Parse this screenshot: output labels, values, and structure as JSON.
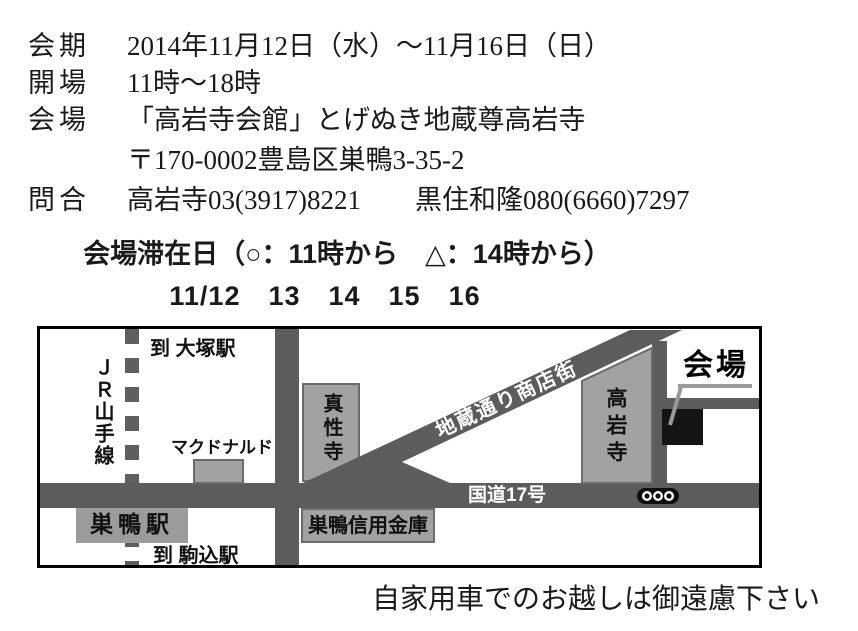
{
  "info": {
    "rows": [
      {
        "label": "会期",
        "value": "2014年11月12日（水）～11月16日（日）"
      },
      {
        "label": "開場",
        "value": "11時～18時"
      },
      {
        "label": "会場",
        "value": "「高岩寺会館」とげぬき地蔵尊高岩寺"
      },
      {
        "label": "",
        "value": "〒170-0002豊島区巣鴨3-35-2"
      },
      {
        "label": "問合",
        "value": "高岩寺03(3917)8221　　黒住和隆080(6660)7297"
      }
    ]
  },
  "schedule": {
    "title_line": "会場滞在日（○：11時から　△：14時から）",
    "dates_line": "11/12　13　14　15　16"
  },
  "map": {
    "labels": {
      "to_otsuka": "到 大塚駅",
      "jr_yamanote": "ＪＲ山手線",
      "mcdonalds": "マクドナルド",
      "shinshoji": "真性寺",
      "sugamo_station": "巣鴨駅",
      "sugamo_shinkin": "巣鴨信用金庫",
      "to_komagome": "到 駒込駅",
      "jizo_street": "地蔵通り商店街",
      "koganji": "高岩寺",
      "route17": "国道17号",
      "venue": "会場"
    },
    "colors": {
      "road": "#5c5c5c",
      "railway": "#5f5f5f",
      "building_fill": "#a2a2a2",
      "building_border": "#6b6b6b",
      "venue_square": "#141414",
      "callout_line": "#9a9a9a",
      "map_border": "#000000"
    }
  },
  "footer": {
    "note": "自家用車でのお越しは御遠慮下さい"
  }
}
